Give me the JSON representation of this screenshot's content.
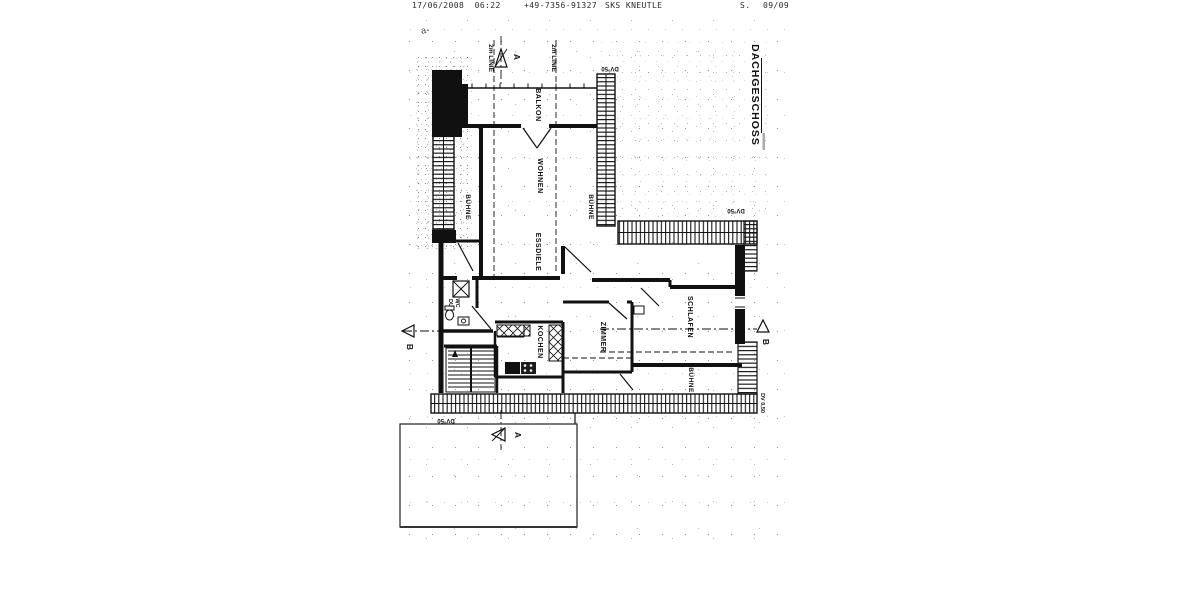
{
  "fax_header": {
    "datetime": "17/06/2008  06:22",
    "fax_number": "+49-7356-91327",
    "sender": "SKS KNEUTLE",
    "page_label": "S.",
    "page_number": "09/09"
  },
  "plan": {
    "title": "DACHGESCHOSS",
    "rooms": {
      "balkon": "BALKON",
      "wohnen": "WOHNEN",
      "buehne_left": "BÜHNE",
      "buehne_right": "BÜHNE",
      "essdiele": "ESSDIELE",
      "du": "DU",
      "wc": "WC",
      "kochen": "KOCHEN",
      "zimmer": "ZIMMER",
      "schlafen": "SCHLAFEN",
      "buehne_bottom": "BÜHNE"
    },
    "markers": {
      "two_m_line_left": "2m LINIE",
      "two_m_line_right": "2m LINIE",
      "section_a": "A",
      "section_b": "B",
      "dv_top": "DV°50",
      "dv_right": "DV°50",
      "dv_bottom_left": "DV°50",
      "dv_bottom_right": "DV 0,50",
      "handwritten_note": "a-"
    }
  },
  "colors": {
    "ink": "#1a1a1a",
    "paper": "#ffffff"
  }
}
